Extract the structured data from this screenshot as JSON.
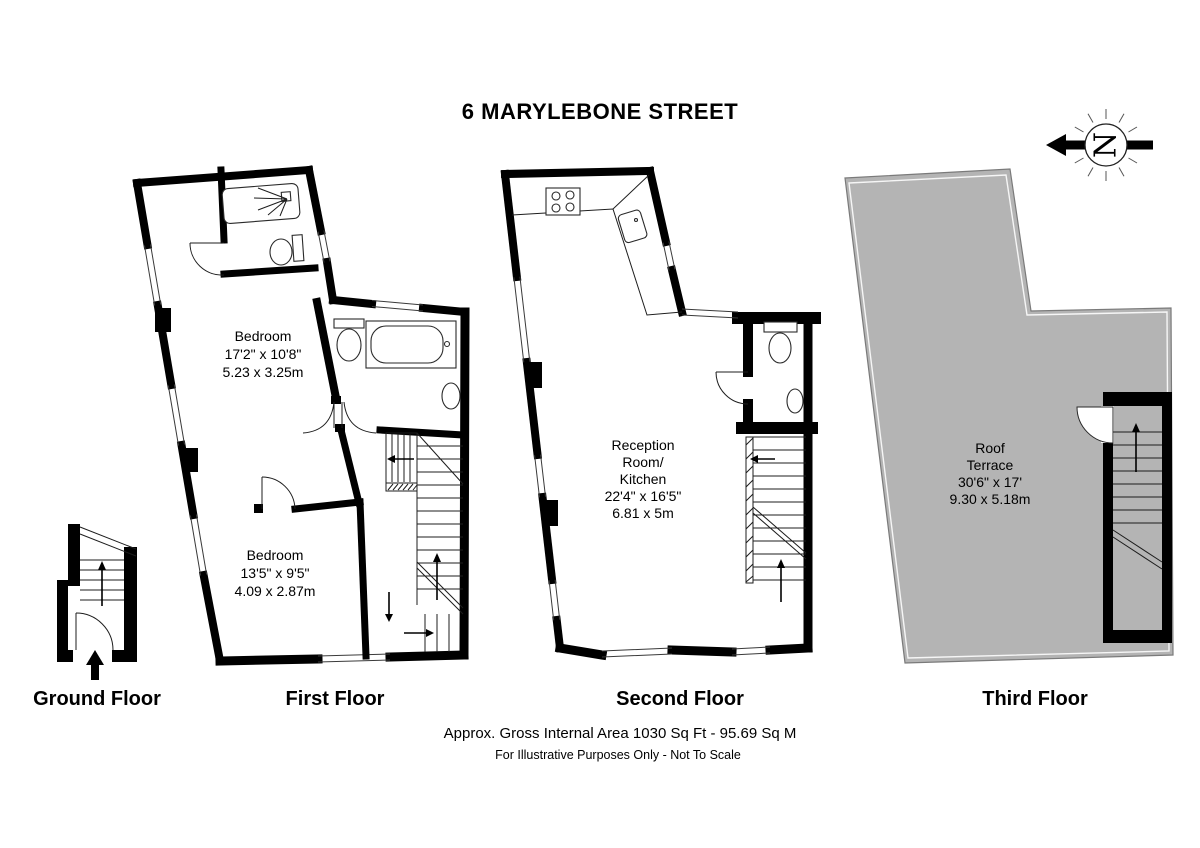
{
  "title": "6 MARYLEBONE STREET",
  "compass": {
    "letter": "N"
  },
  "captions": {
    "ground": "Ground Floor",
    "first": "First Floor",
    "second": "Second Floor",
    "third": "Third Floor"
  },
  "rooms": {
    "bedroom1": {
      "name": "Bedroom",
      "imperial": "17'2\" x 10'8\"",
      "metric": "5.23 x 3.25m"
    },
    "bedroom2": {
      "name": "Bedroom",
      "imperial": "13'5\" x 9'5\"",
      "metric": "4.09 x 2.87m"
    },
    "reception": {
      "name_line1": "Reception",
      "name_line2": "Room/",
      "name_line3": "Kitchen",
      "imperial": "22'4\" x 16'5\"",
      "metric": "6.81 x 5m"
    },
    "roof_terrace": {
      "name_line1": "Roof",
      "name_line2": "Terrace",
      "imperial": "30'6\" x 17'",
      "metric": "9.30 x 5.18m"
    }
  },
  "footer": {
    "area": "Approx. Gross Internal Area 1030 Sq Ft - 95.69 Sq M",
    "disclaimer": "For Illustrative Purposes Only - Not To Scale"
  },
  "colors": {
    "wall": "#000000",
    "terrace_fill": "#b4b4b4",
    "background": "#ffffff"
  }
}
